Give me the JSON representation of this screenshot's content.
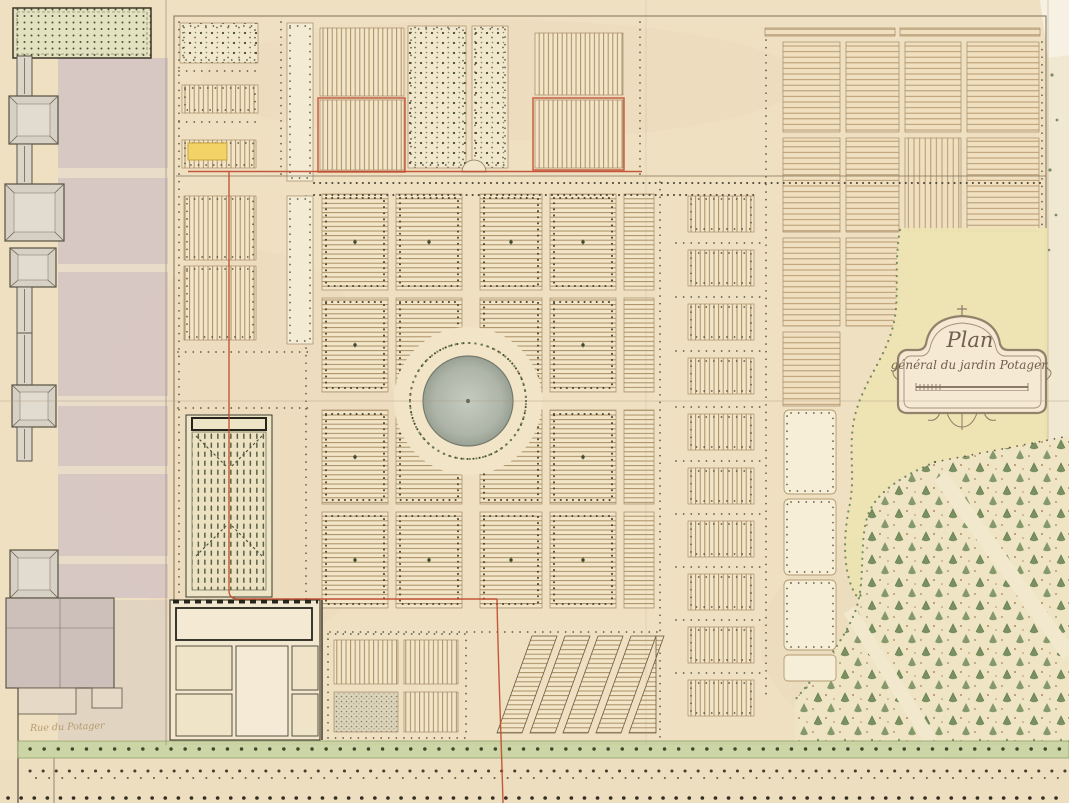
{
  "map": {
    "cartouche": {
      "line1": "Plan",
      "line2": "général du jardin Potager."
    },
    "street_label": "Rue du Potager",
    "colors": {
      "paper": "#efe0c2",
      "ink": "#5a4a36",
      "plot_hatch": "#a98e63",
      "tree_green": "#7c9162",
      "avenue_band_green": "#cbd5a5",
      "basin_gray": "#aeb5a8",
      "building_wash": "#d2c2c3",
      "red_survey_line": "#c14c30",
      "yellow_highlight": "#f3d266"
    }
  }
}
